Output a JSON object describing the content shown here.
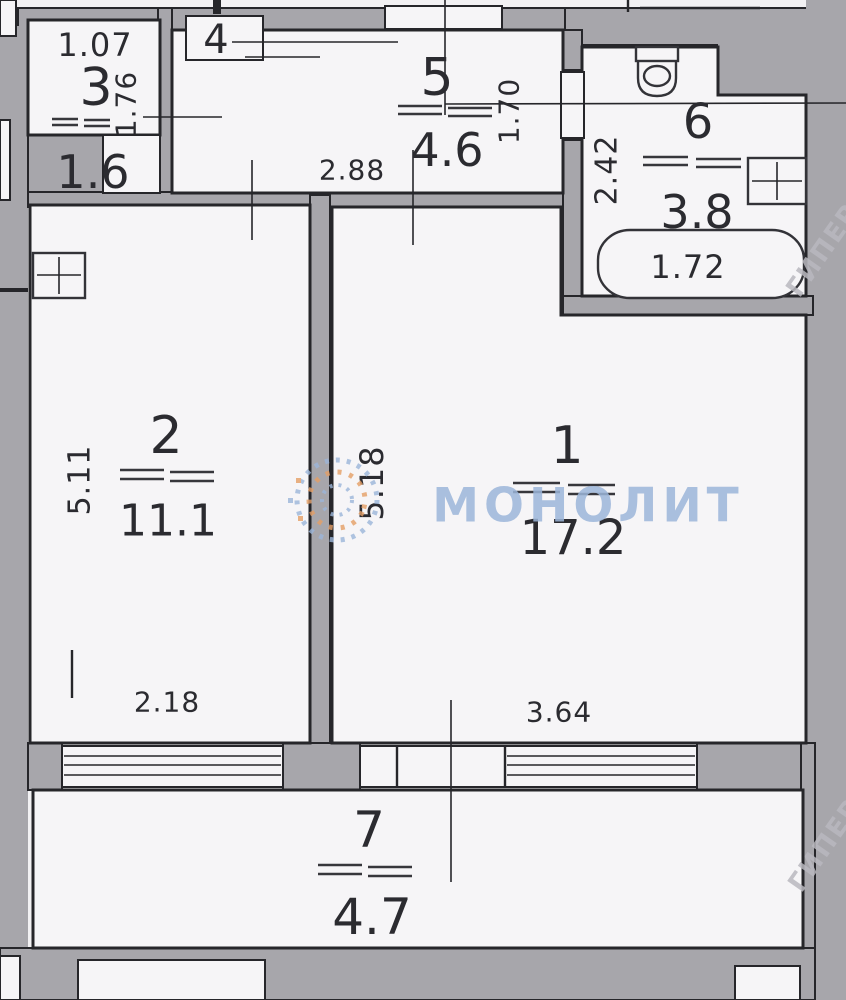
{
  "plan": {
    "type": "apartment-floor-plan",
    "watermark": {
      "brand": "МОНОЛИТ",
      "side_mark": "ГИПЕР"
    },
    "colors": {
      "wall": "#a7a6ab",
      "floor": "#f6f5f7",
      "line": "#26262a",
      "wmblue": "#9cb6da",
      "wmorange": "#e59f66"
    },
    "rooms": {
      "r1": {
        "number": "1",
        "area": "17.2",
        "dim_side": "5.18",
        "dim_bottom": "3.64"
      },
      "r2": {
        "number": "2",
        "area": "11.1",
        "dim_side": "5.11",
        "dim_bottom": "2.18"
      },
      "r3": {
        "number": "3",
        "area": "1.6",
        "dim_top": "1.07",
        "dim_side": "1.76"
      },
      "r4": {
        "number": "4"
      },
      "r5": {
        "number": "5",
        "area": "4.6",
        "dim_bottom": "2.88",
        "dim_side": "1.70"
      },
      "r6": {
        "number": "6",
        "area": "3.8",
        "dim_side": "2.42",
        "tub_length": "1.72"
      },
      "r7": {
        "number": "7",
        "area": "4.7"
      }
    }
  }
}
